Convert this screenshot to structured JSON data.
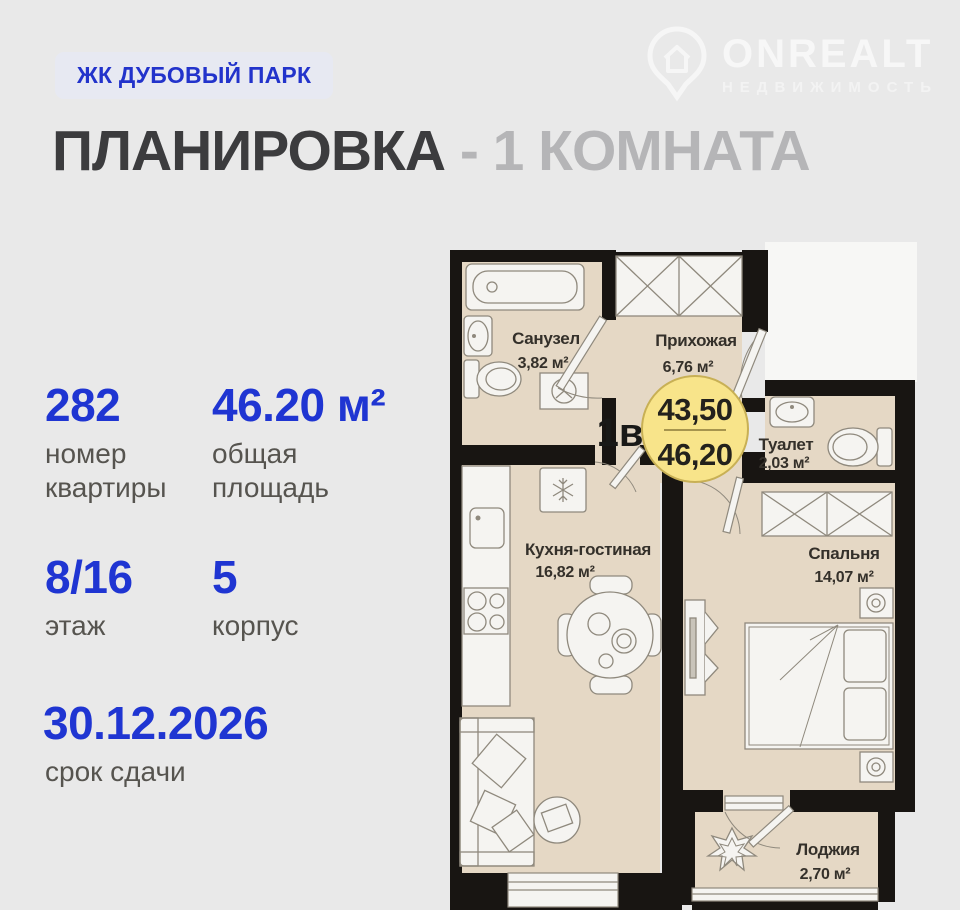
{
  "header": {
    "badge": "ЖК ДУБОВЫЙ ПАРК",
    "title_dark": "ПЛАНИРОВКА",
    "title_light": "- 1 КОМНАТА",
    "logo": {
      "name": "ONREALT",
      "subtitle": "НЕДВИЖИМОСТЬ"
    }
  },
  "stats": [
    {
      "value": "282",
      "label": "номер\nквартиры"
    },
    {
      "value": "46.20 м²",
      "label": "общая\nплощадь"
    },
    {
      "value": "8/16",
      "label": "этаж"
    },
    {
      "value": "5",
      "label": "корпус"
    },
    {
      "value": "30.12.2026",
      "label": "срок сдачи"
    }
  ],
  "floorplan": {
    "unit_label": "1в",
    "area_badge": {
      "living": "43,50",
      "total": "46,20"
    },
    "rooms": [
      {
        "name": "Санузел",
        "area": "3,82 м²"
      },
      {
        "name": "Прихожая",
        "area": "6,76 м²"
      },
      {
        "name": "Туалет",
        "area": "2,03 м²"
      },
      {
        "name": "Кухня-гостиная",
        "area": "16,82 м²"
      },
      {
        "name": "Спальня",
        "area": "14,07 м²"
      },
      {
        "name": "Лоджия",
        "area": "2,70 м²"
      }
    ],
    "colors": {
      "wall": "#181512",
      "floor": "#e5d8c5",
      "fixture": "#f5f4f1",
      "badge_fill": "#f8e48a",
      "badge_stroke": "#c8b055",
      "accent_blue": "#1f35d2"
    }
  }
}
